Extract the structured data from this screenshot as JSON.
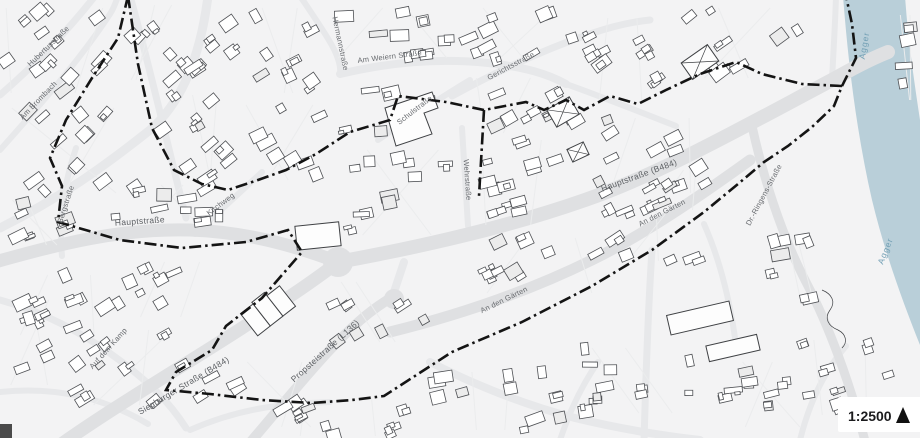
{
  "map": {
    "scale_label": "1:2500",
    "river_label_north": "Agger",
    "river_label_south": "Agger",
    "labels": {
      "hauptstrasse_west": "Hauptstraße",
      "hauptstrasse_b484": "Hauptstraße (B484)",
      "siegburger": "Siegburger Straße (B484)",
      "propsteistrasse": "Propsteistraße (L136)",
      "an_den_gaerten_a": "An den Gärten",
      "an_den_gaerten_b": "An den Gärten",
      "dr_ringens": "Dr.-Ringens-Straße",
      "am_weiern": "Am Weiern Straße",
      "schulstrasse": "Schulstraße",
      "gerichtsstrasse": "Gerichtsstraße",
      "hubertusstrasse": "Hubertusstraße",
      "am_brombach": "Am Brombach",
      "bergstrasse": "Bergstraße",
      "kirchweg": "Kirchweg",
      "wehrstrasse": "Wehrstraße",
      "hermannstrasse": "Hermannstraße",
      "auf_dem_kamp": "Auf dem Kamp"
    },
    "colors": {
      "background": "#f3f3f4",
      "street": "#dfe0e2",
      "street_minor": "#e7e8ea",
      "building_fill": "#ffffff",
      "building_stroke": "#4e5054",
      "boundary": "#141414",
      "river": "#b9cfd9",
      "river_label": "#73a0b5",
      "label": "#66696d"
    }
  }
}
